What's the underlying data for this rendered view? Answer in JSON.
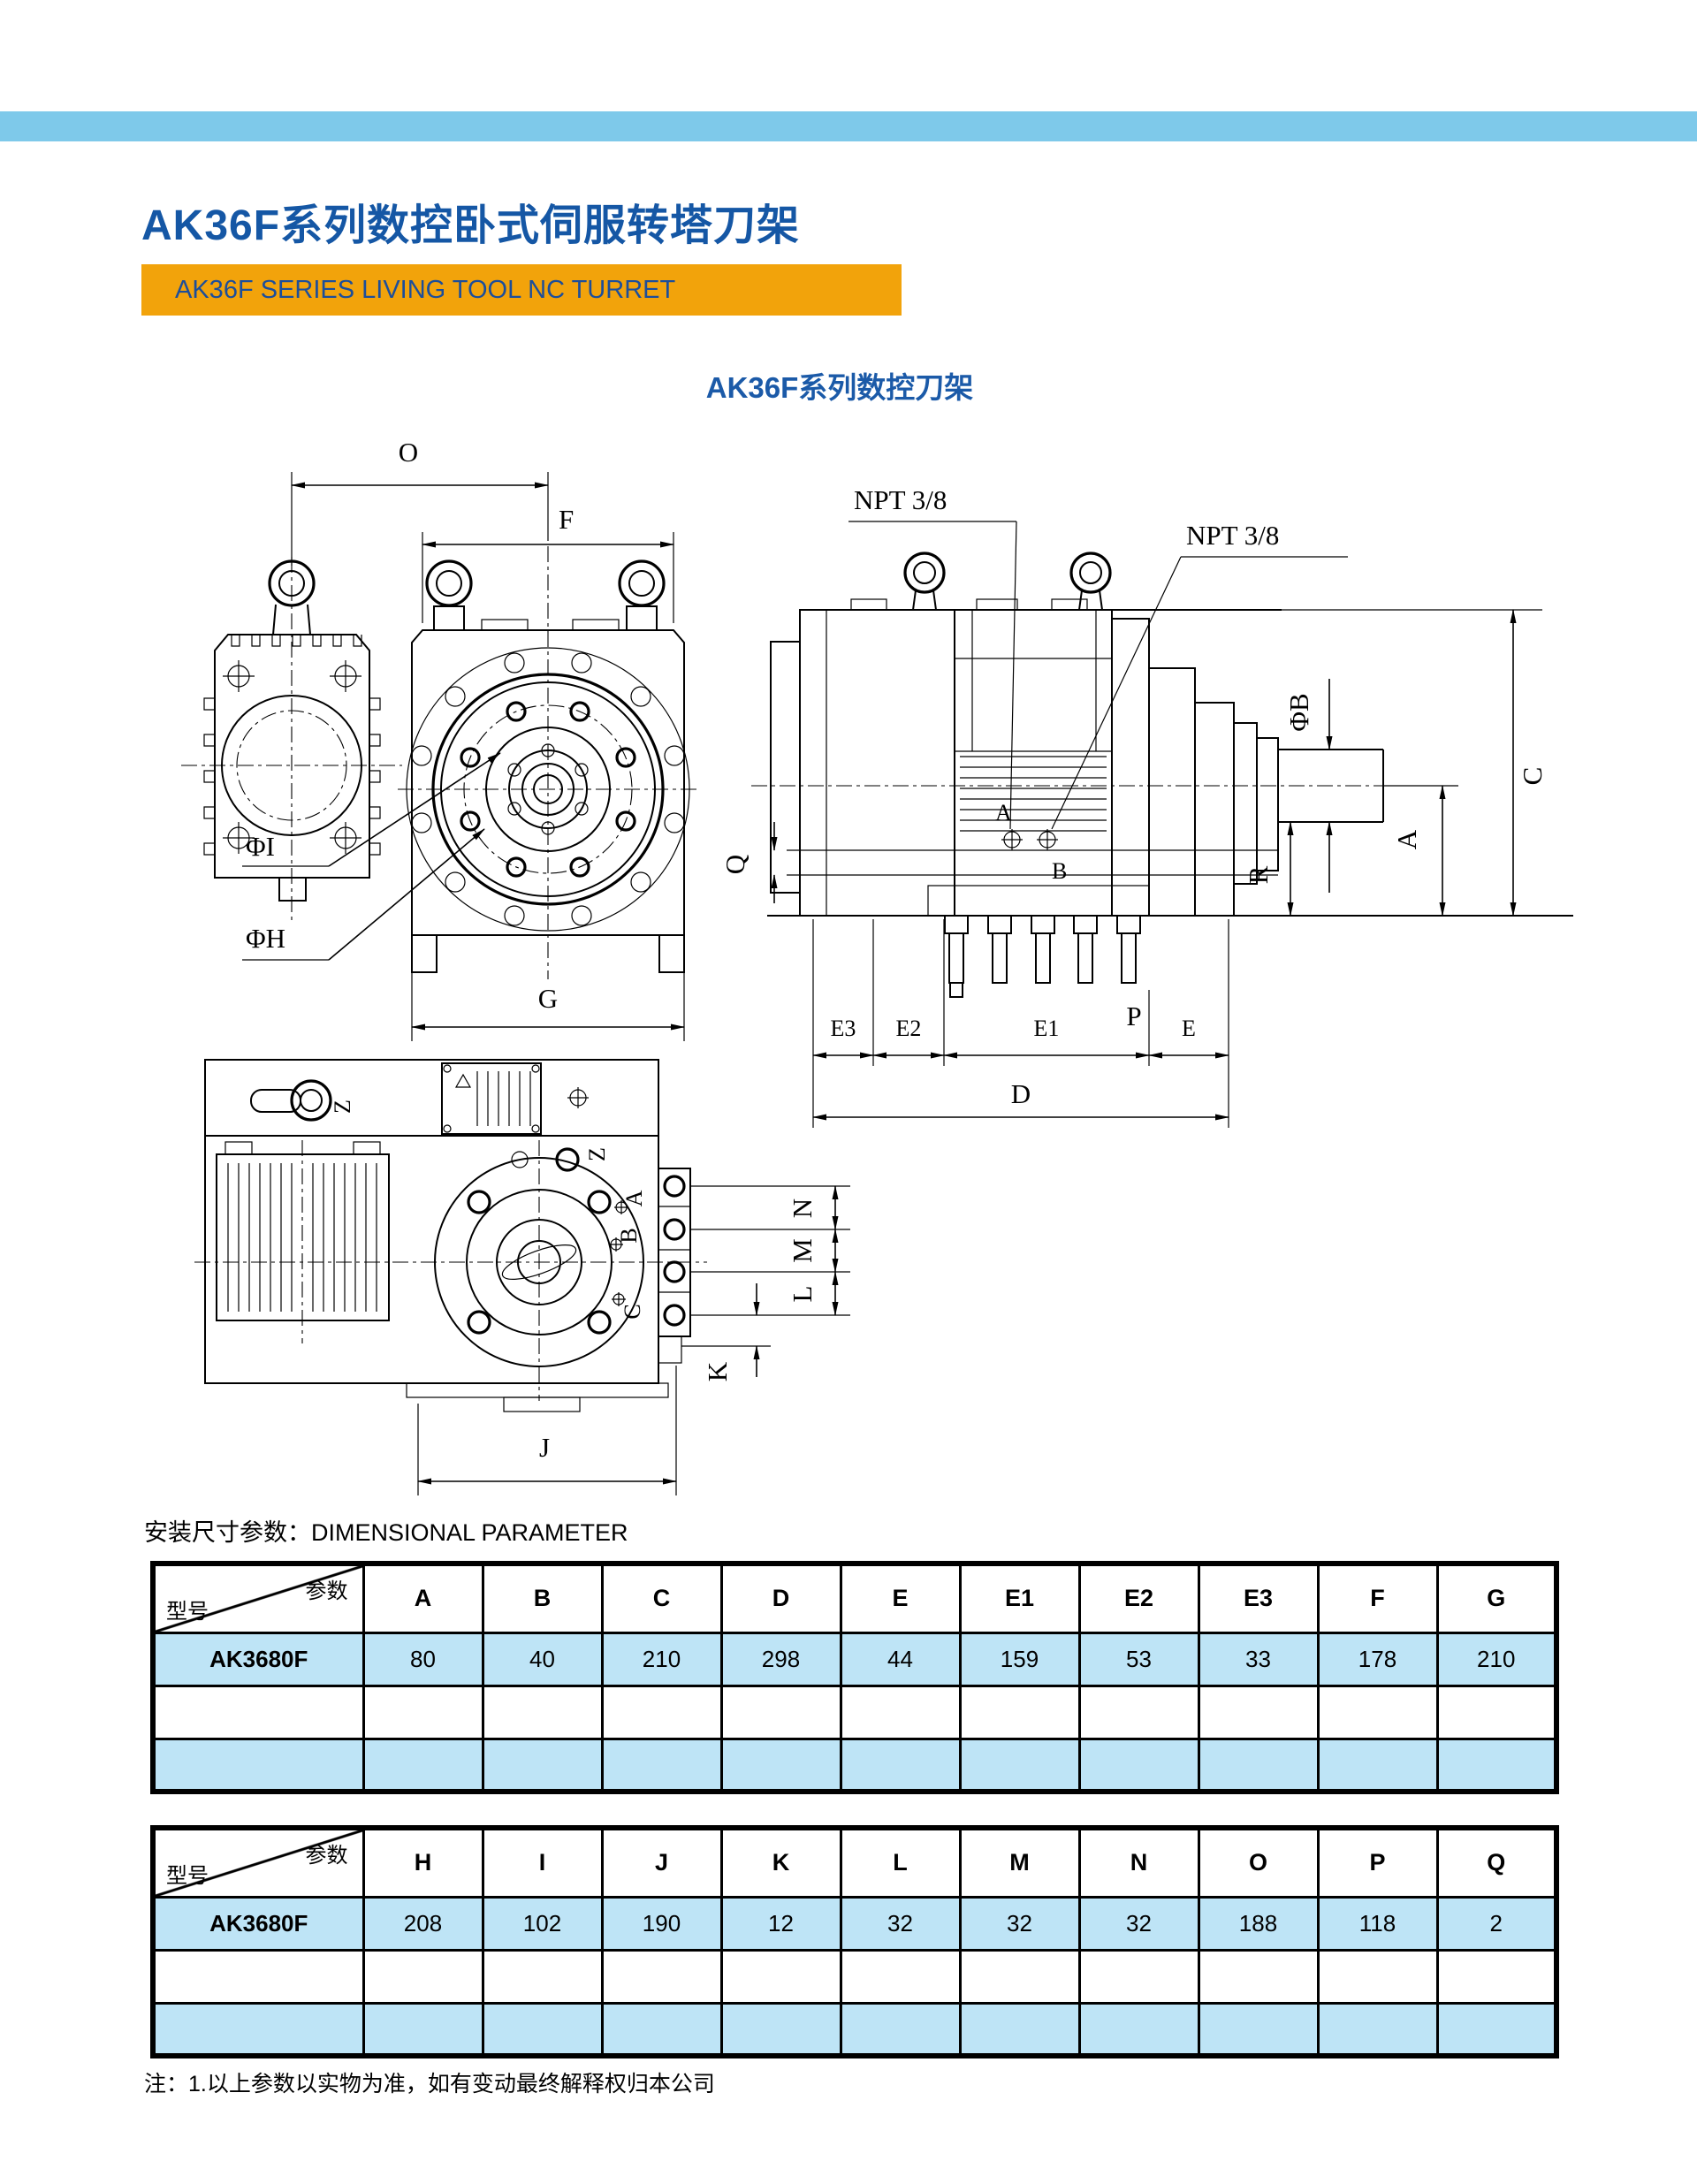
{
  "page": {
    "title": "AK36F系列数控卧式伺服转塔刀架",
    "subtitle": "AK36F SERIES LIVING TOOL NC TURRET",
    "drawing_caption": "AK36F系列数控刀架",
    "section_label": "安装尺寸参数：DIMENSIONAL PARAMETER",
    "footnote": "注：1.以上参数以实物为准，如有变动最终解释权归本公司"
  },
  "colors": {
    "top_bar": "#7EC9EA",
    "title_text": "#1557A5",
    "banner_bg": "#F2A30B",
    "banner_text": "#1C4E9B",
    "caption_text": "#1B5AA8",
    "table_highlight": "#BEE4F6",
    "line": "#000000"
  },
  "drawing": {
    "front": {
      "o": "O",
      "f": "F",
      "phi_i": "ΦI",
      "phi_h": "ΦH",
      "g": "G"
    },
    "side": {
      "npt_left": "NPT 3/8",
      "npt_right": "NPT 3/8",
      "phi_b": "ΦB",
      "c": "C",
      "a": "A",
      "r": "R",
      "q": "Q",
      "p": "P",
      "port_a": "A",
      "port_b": "B",
      "e3": "E3",
      "e2": "E2",
      "e1": "E1",
      "e": "E",
      "d": "D"
    },
    "bottom": {
      "z1": "Z",
      "z2": "Z",
      "a": "A",
      "b": "B",
      "c": "C",
      "n": "N",
      "m": "M",
      "l": "L",
      "k": "K",
      "j": "J"
    }
  },
  "dimension_table_1": {
    "corner_top": "参数",
    "corner_bottom": "型号",
    "columns": [
      "A",
      "B",
      "C",
      "D",
      "E",
      "E1",
      "E2",
      "E3",
      "F",
      "G"
    ],
    "rows": [
      {
        "model": "AK3680F",
        "values": [
          "80",
          "40",
          "210",
          "298",
          "44",
          "159",
          "53",
          "33",
          "178",
          "210"
        ]
      }
    ]
  },
  "dimension_table_2": {
    "corner_top": "参数",
    "corner_bottom": "型号",
    "columns": [
      "H",
      "I",
      "J",
      "K",
      "L",
      "M",
      "N",
      "O",
      "P",
      "Q"
    ],
    "rows": [
      {
        "model": "AK3680F",
        "values": [
          "208",
          "102",
          "190",
          "12",
          "32",
          "32",
          "32",
          "188",
          "118",
          "2"
        ]
      }
    ]
  }
}
